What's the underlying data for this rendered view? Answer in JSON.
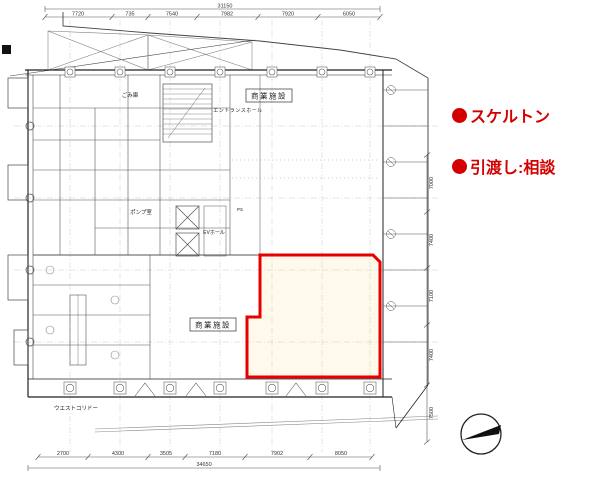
{
  "notes": {
    "color": "#d40000",
    "items": [
      {
        "label": "スケルトン"
      },
      {
        "label": "引渡し:相談"
      }
    ]
  },
  "plan": {
    "rooms": {
      "commercial_upper": "商業施設",
      "commercial_lower": "商業施設",
      "entrance_hall": "エントランスホール",
      "ev_hall": "EVホール",
      "pump_room": "ポンプ室",
      "garbage_room": "ごみ庫",
      "pipe_shaft": "PS",
      "west_corridor": "ウエストコリドー"
    },
    "dimensions": {
      "top_total": "31150",
      "top_segments": [
        "7720",
        "735",
        "7540",
        "7982",
        "7920",
        "6050"
      ],
      "bottom_segments": [
        "2700",
        "4300",
        "3505",
        "7180",
        "7902",
        "8050"
      ],
      "bottom_total": "34650",
      "right_segments": [
        "7000",
        "7400",
        "7100",
        "7400",
        "7500"
      ]
    },
    "highlight_color": "#e60000"
  }
}
